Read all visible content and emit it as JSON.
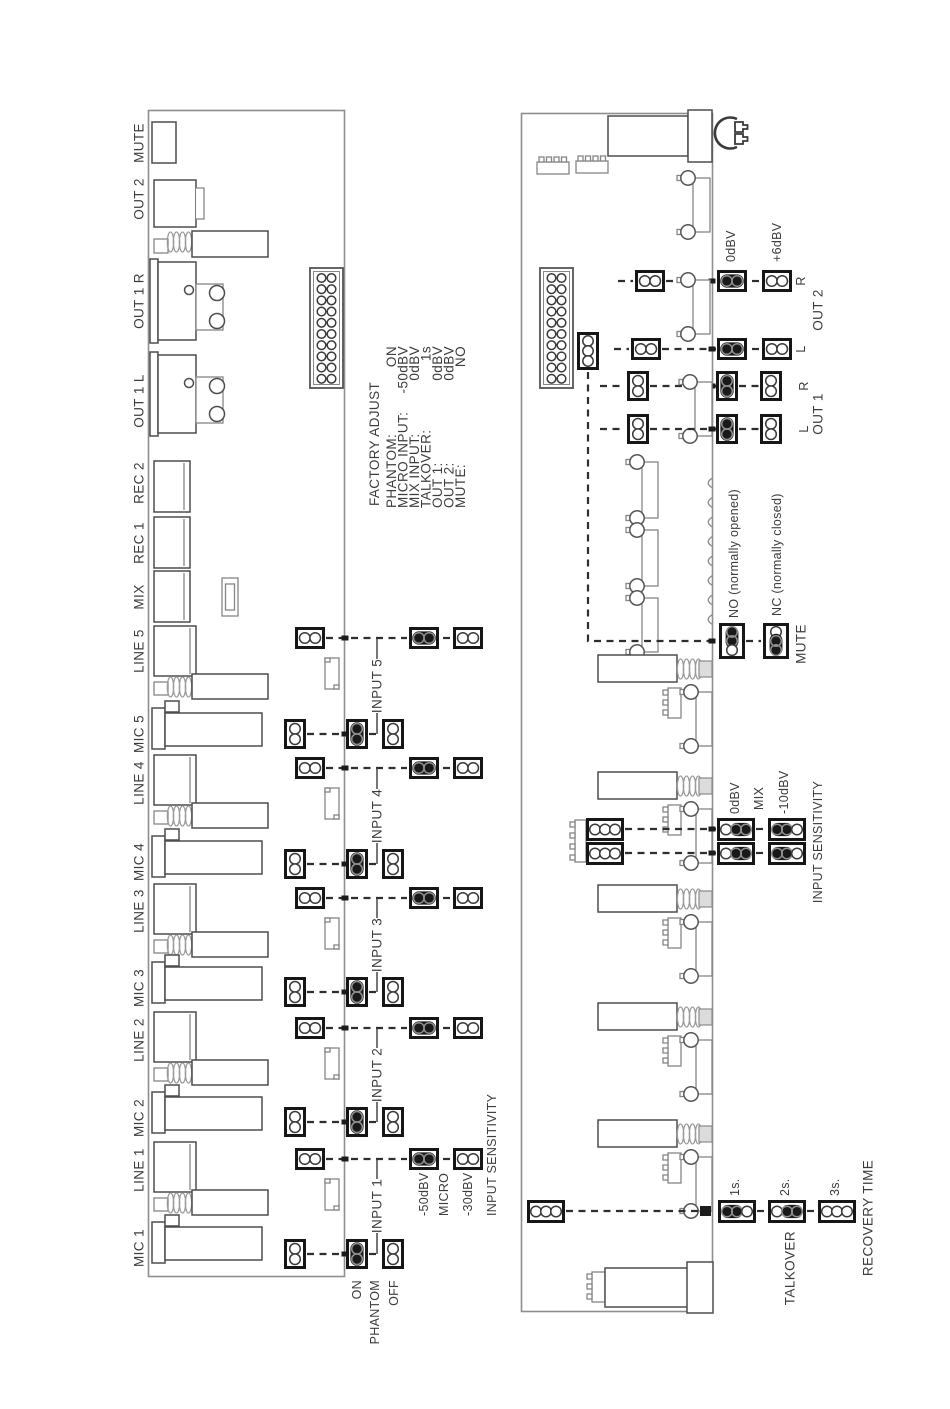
{
  "board1": {
    "connectors": [
      "MUTE",
      "OUT 2",
      "OUT 1 R",
      "OUT 1 L",
      "REC 2",
      "REC 1",
      "MIX",
      "LINE 5",
      "MIC 5",
      "LINE 4",
      "MIC 4",
      "LINE 3",
      "MIC 3",
      "LINE 2",
      "MIC 2",
      "LINE 1",
      "MIC 1"
    ],
    "inputs": [
      "INPUT 5",
      "INPUT 4",
      "INPUT 3",
      "INPUT 2",
      "INPUT 1"
    ],
    "phantom": {
      "on": "ON",
      "label": "PHANTOM",
      "off": "OFF"
    },
    "sensitivity": {
      "micro_high": "-50dBV",
      "micro": "MICRO",
      "micro_low": "-30dBV",
      "title": "INPUT SENSITIVITY"
    }
  },
  "factory_adjust": {
    "title": "FACTORY ADJUST",
    "rows": [
      {
        "name": "PHANTOM:",
        "value": "ON"
      },
      {
        "name": "MICRO INPUT:",
        "value": "-50dBV"
      },
      {
        "name": "MIX INPUT:",
        "value": "0dBV"
      },
      {
        "name": "TALKOVER:",
        "value": "1s"
      },
      {
        "name": "OUT 1:",
        "value": "0dBV"
      },
      {
        "name": "OUT 2:",
        "value": "0dBV"
      },
      {
        "name": "MUTE:",
        "value": "NO"
      }
    ]
  },
  "board2": {
    "out_level": {
      "opt_0dbv": "0dBV",
      "opt_6dbv": "+6dBV"
    },
    "out2": {
      "label": "OUT 2",
      "r": "R",
      "l": "L"
    },
    "out1": {
      "label": "OUT 1",
      "r": "R",
      "l": "L"
    },
    "mute": {
      "no": "NO (normally opened)",
      "nc": "NC (normally closed)",
      "label": "MUTE"
    },
    "mix": {
      "opt_0dbv": "0dBV",
      "label": "MIX",
      "opt_m10dbv": "-10dBV",
      "title": "INPUT SENSITIVITY"
    },
    "talkover": {
      "s1": "1s.",
      "s2": "2s.",
      "s3": "3s.",
      "label": "TALKOVER",
      "recovery": "RECOVERY TIME"
    }
  }
}
